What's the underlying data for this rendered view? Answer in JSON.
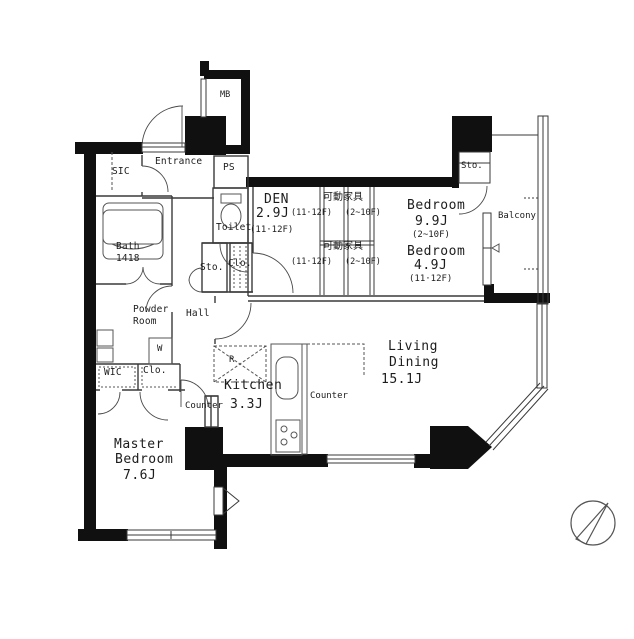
{
  "plan": {
    "mb": "MB",
    "ps": "PS",
    "entrance": "Entrance",
    "sic": "SIC",
    "bath": {
      "name": "Bath",
      "size": "1418"
    },
    "toilet": "Toilet",
    "hall": {
      "name": "Hall",
      "sto": "Sto.",
      "clo": "Clo."
    },
    "den": {
      "name": "DEN",
      "size": "2.9J",
      "floors": "(11·12F)"
    },
    "furniture1": {
      "name": "可動家具",
      "alt_left": "(11·12F)",
      "alt_right": "(2~10F)"
    },
    "furniture2": {
      "name": "可動家具",
      "alt_left": "(11·12F)",
      "alt_right": "(2~10F)"
    },
    "bedroom1": {
      "name": "Bedroom",
      "size": "9.9J",
      "floors": "(2~10F)",
      "sto": "Sto."
    },
    "bedroom2": {
      "name": "Bedroom",
      "size": "4.9J",
      "floors": "(11·12F)"
    },
    "balcony": "Balcony",
    "powder": {
      "line1": "Powder",
      "line2": "Room"
    },
    "washer": "W",
    "wic": "WIC",
    "clo2": "Clo.",
    "fridge": "R",
    "counter_left": "Counter",
    "counter_right": "Counter",
    "kitchen": {
      "name": "Kitchen",
      "size": "3.3J"
    },
    "living": {
      "line1": "Living",
      "line2": "Dining",
      "size": "15.1J"
    },
    "master": {
      "line1": "Master",
      "line2": "Bedroom",
      "size": "7.6J"
    }
  },
  "colors": {
    "wall": "#101010",
    "line": "#3a3a3a",
    "fixture": "#555555",
    "text": "#1c1c1c"
  }
}
